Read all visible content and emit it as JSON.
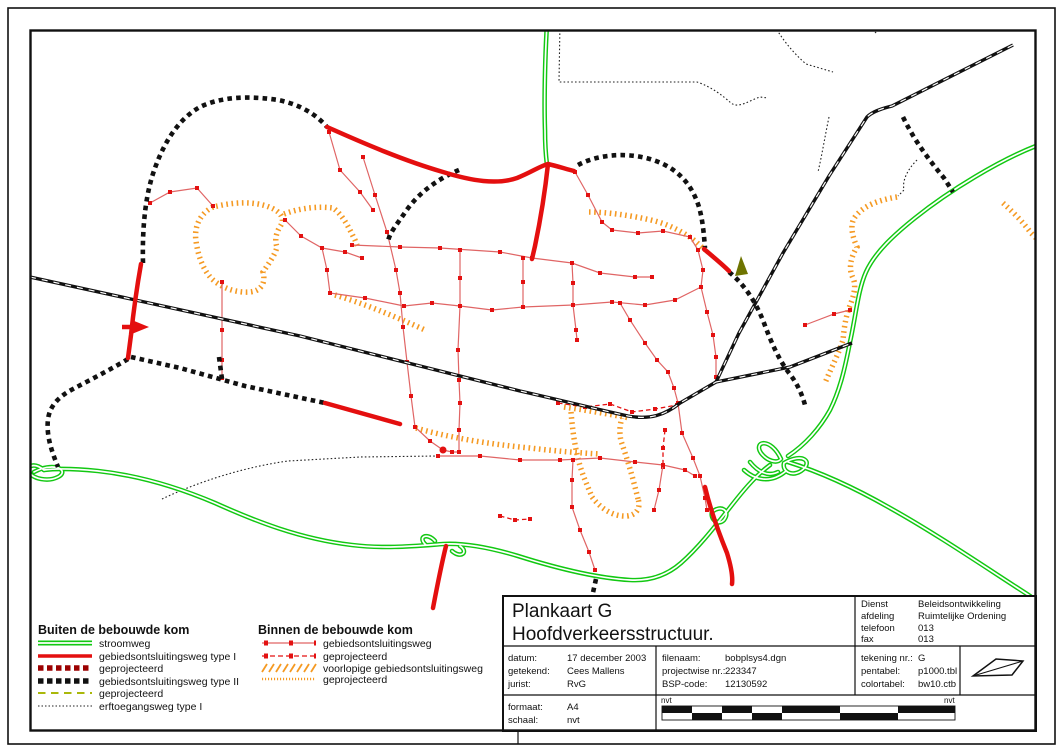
{
  "colors": {
    "green": "#12c812",
    "red": "#e40f0f",
    "net_red": "#e06565",
    "square_red": "#e31111",
    "orange": "#f59a23",
    "olive_dash": "#aab80a",
    "olive_arrow": "#6e7400",
    "proj_red": "#9b0000",
    "dark": "#111111"
  },
  "legend": {
    "left": {
      "title": "Buiten de bebouwde kom",
      "items": [
        {
          "label": "stroomweg"
        },
        {
          "label": "gebiedsontsluitingsweg type I"
        },
        {
          "label": "geprojecteerd"
        },
        {
          "label": "gebiedsontsluitingsweg  type II"
        },
        {
          "label": "geprojecteerd"
        },
        {
          "label": "erftoegangsweg type I"
        }
      ]
    },
    "right": {
      "title": "Binnen de bebouwde kom",
      "items": [
        {
          "label": "gebiedsontsluitingsweg"
        },
        {
          "label": "geprojecteerd"
        },
        {
          "label": "voorlopige gebiedsontsluitingsweg"
        },
        {
          "label": "geprojecteerd"
        }
      ]
    }
  },
  "title_block": {
    "title_line1": "Plankaart G",
    "title_line2": "Hoofdverkeersstructuur.",
    "org": {
      "labels": [
        "Dienst",
        "afdeling",
        "telefoon",
        "fax"
      ],
      "values": [
        "Beleidsontwikkeling",
        "Ruimtelijke Ordening",
        "013",
        "013"
      ]
    },
    "meta_left": {
      "labels": [
        "datum:",
        "getekend:",
        "jurist:"
      ],
      "values": [
        "17 december 2003",
        "Cees Mallens",
        "RvG"
      ]
    },
    "meta_mid": {
      "labels": [
        "filenaam:",
        "projectwise nr.:",
        "BSP-code:"
      ],
      "values": [
        "bobplsys4.dgn",
        "223347",
        "12130592"
      ]
    },
    "meta_right": {
      "labels": [
        "tekening nr.:",
        "pentabel:",
        "colortabel:"
      ],
      "values": [
        "G",
        "p1000.tbl",
        "bw10.ctb"
      ]
    },
    "format": {
      "labels": [
        "formaat:",
        "schaal:"
      ],
      "values": [
        "A4",
        "nvt"
      ]
    },
    "scalebar": {
      "left_label": "nvt",
      "right_label": "nvt"
    }
  }
}
